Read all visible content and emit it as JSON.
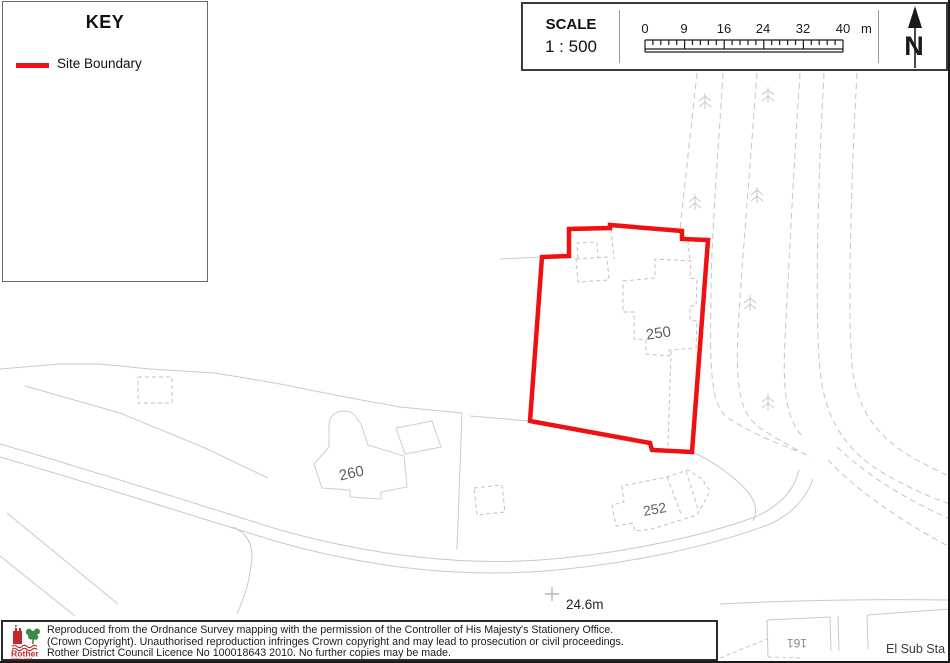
{
  "key_panel": {
    "title": "KEY",
    "legend": [
      {
        "label": "Site Boundary"
      }
    ]
  },
  "scale_panel": {
    "heading": "SCALE",
    "ratio": "1 : 500",
    "ticks": [
      "0",
      "9",
      "16",
      "24",
      "32",
      "40"
    ],
    "unit": "m"
  },
  "compass": {
    "label": "N"
  },
  "map": {
    "labels": {
      "building_250": "250",
      "building_260": "260",
      "building_252": "252",
      "building_161": "161",
      "el_sub_sta": "El Sub Sta",
      "spot_height": "24.6m"
    },
    "colors": {
      "site_boundary": "#ee1111",
      "map_line": "#c8c8c8"
    }
  },
  "footer": {
    "logo_title": "Rother",
    "logo_subtitle": "District Council",
    "lines": [
      "Reproduced from the Ordnance Survey mapping with the permission of the Controller of His Majesty's Stationery Office.",
      "(Crown Copyright). Unauthorised reproduction infringes Crown copyright and may lead to prosecution or civil proceedings.",
      "Rother District Council Licence No 100018643 2010. No further copies may be made."
    ]
  }
}
